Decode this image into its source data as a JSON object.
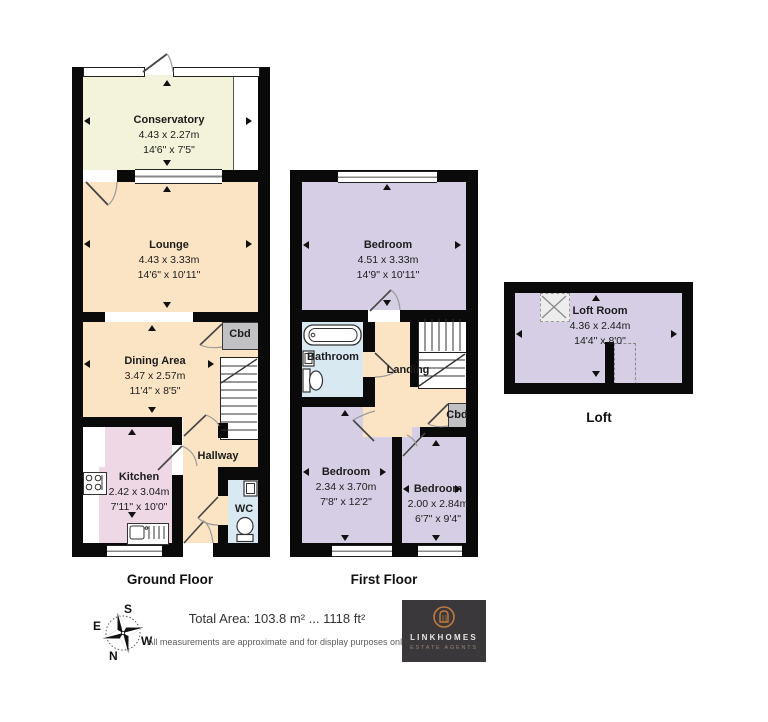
{
  "floors": {
    "ground": {
      "label": "Ground Floor",
      "rooms": {
        "conservatory": {
          "name": "Conservatory",
          "metric": "4.43 x 2.27m",
          "imperial": "14'6\" x 7'5\""
        },
        "lounge": {
          "name": "Lounge",
          "metric": "4.43 x 3.33m",
          "imperial": "14'6\" x 10'11\""
        },
        "dining": {
          "name": "Dining Area",
          "metric": "3.47 x 2.57m",
          "imperial": "11'4\" x 8'5\""
        },
        "kitchen": {
          "name": "Kitchen",
          "metric": "2.42 x 3.04m",
          "imperial": "7'11\" x 10'0\""
        },
        "hallway": {
          "name": "Hallway"
        },
        "wc": {
          "name": "WC"
        },
        "cbd": {
          "name": "Cbd"
        }
      }
    },
    "first": {
      "label": "First Floor",
      "rooms": {
        "bedroom1": {
          "name": "Bedroom",
          "metric": "4.51 x 3.33m",
          "imperial": "14'9\" x 10'11\""
        },
        "bathroom": {
          "name": "Bathroom"
        },
        "landing": {
          "name": "Landing"
        },
        "cbd": {
          "name": "Cbd"
        },
        "bedroom2": {
          "name": "Bedroom",
          "metric": "2.34 x 3.70m",
          "imperial": "7'8\" x 12'2\""
        },
        "bedroom3": {
          "name": "Bedroom",
          "metric": "2.00 x 2.84m",
          "imperial": "6'7\" x 9'4\""
        }
      }
    },
    "loft": {
      "label": "Loft",
      "rooms": {
        "loftroom": {
          "name": "Loft Room",
          "metric": "4.36 x 2.44m",
          "imperial": "14'4\" x 8'0\""
        }
      }
    }
  },
  "footer": {
    "total_area": "Total Area: 103.8 m² ... 1118 ft²",
    "disclaimer": "All measurements are approximate and for display purposes only"
  },
  "compass": {
    "n": "N",
    "s": "S",
    "e": "E",
    "w": "W"
  },
  "logo": {
    "name": "LINKHOMES",
    "tagline": "ESTATE AGENTS"
  },
  "colors": {
    "wall": "#0a0a0a",
    "conservatory": "#f2f3da",
    "living": "#fbe4c4",
    "kitchen": "#eed8e6",
    "bathroom": "#d8e9f2",
    "bedroom": "#d5cee5",
    "cupboard": "#c1c0c2",
    "logo_bg": "#3a383a",
    "logo_accent": "#c07a3c"
  }
}
